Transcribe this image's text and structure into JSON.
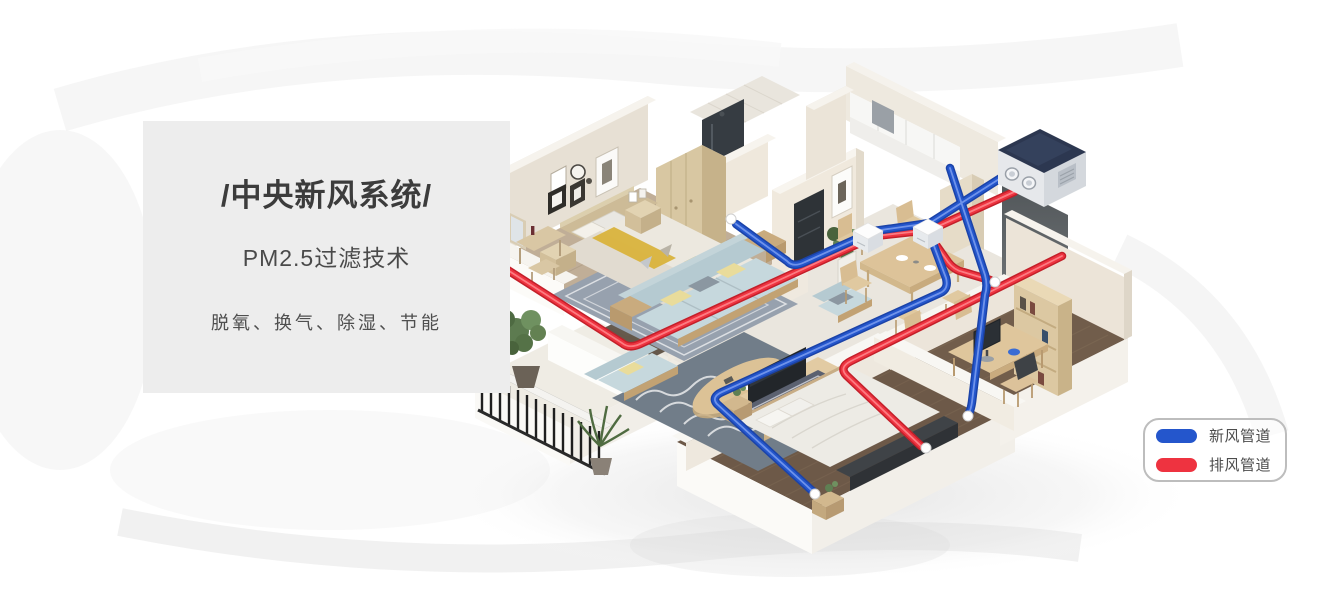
{
  "panel": {
    "title": "/中央新风系统/",
    "subtitle": "PM2.5过滤技术",
    "tagline": "脱氧、换气、除湿、节能"
  },
  "legend": {
    "items": [
      {
        "id": "fresh-air-duct",
        "label": "新风管道",
        "color": "#2456cc"
      },
      {
        "id": "exhaust-air-duct",
        "label": "排风管道",
        "color": "#ee3340"
      }
    ]
  },
  "scene": {
    "colors": {
      "fresh_pipe": "#2456cc",
      "exhaust_pipe": "#ee3340",
      "hrv_unit_top": "#2c3750",
      "panel_bg": "#ededed"
    }
  }
}
